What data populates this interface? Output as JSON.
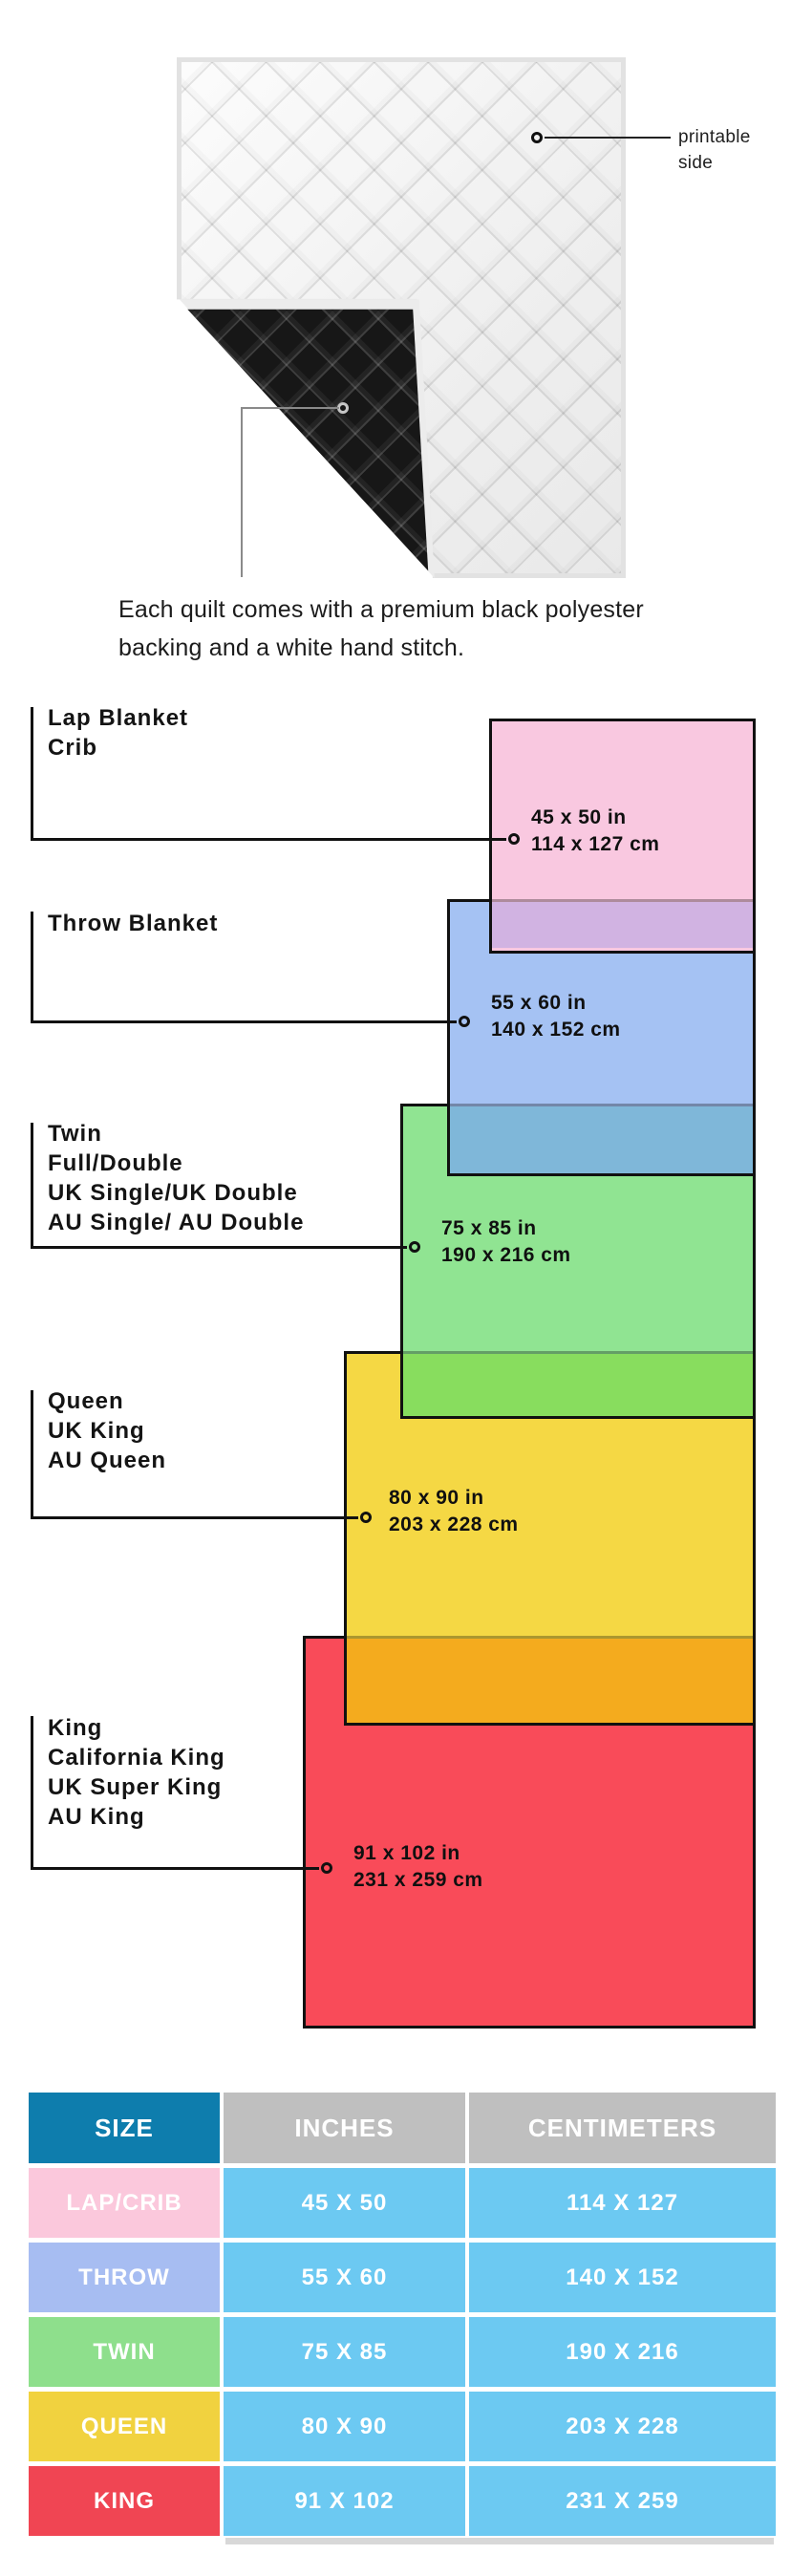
{
  "quilt": {
    "printable_label": "printable side",
    "caption": "Each quilt comes with a premium black polyester backing and a white hand stitch."
  },
  "diagram": {
    "sizes": [
      {
        "name_lines": [
          "Lap Blanket",
          "Crib"
        ],
        "inches": "45 x 50 in",
        "cm": "114 x 127 cm",
        "fill": "#f9c8e0"
      },
      {
        "name_lines": [
          "Throw Blanket"
        ],
        "inches": "55 x 60 in",
        "cm": "140 x 152 cm",
        "fill": "#a5c2f3"
      },
      {
        "name_lines": [
          "Twin",
          "Full/Double",
          "UK Single/UK Double",
          "AU Single/ AU Double"
        ],
        "inches": "75 x 85 in",
        "cm": "190 x 216 cm",
        "fill": "#90e492"
      },
      {
        "name_lines": [
          "Queen",
          "UK King",
          "AU Queen"
        ],
        "inches": "80 x 90 in",
        "cm": "203 x 228 cm",
        "fill": "#f5d844"
      },
      {
        "name_lines": [
          "King",
          "California King",
          "UK Super King",
          "AU King"
        ],
        "inches": "91 x 102 in",
        "cm": "231 x 259 cm",
        "fill": "#f94b59"
      }
    ],
    "overlap_fills": {
      "lap_throw": "#d1b3e2",
      "throw_twin": "#7fb7d9",
      "twin_queen": "#88dd5e",
      "queen_king": "#f4ab1e"
    }
  },
  "table": {
    "headers": [
      "SIZE",
      "INCHES",
      "CENTIMETERS"
    ],
    "header_colors": {
      "size": "#0e7dad",
      "measures": "#bfbfbf"
    },
    "cell_color": "#6cc9f2",
    "rows": [
      {
        "label": "LAP/CRIB",
        "inches": "45 X 50",
        "cm": "114 X 127",
        "color": "#fbc8dc"
      },
      {
        "label": "THROW",
        "inches": "55 X 60",
        "cm": "140 X 152",
        "color": "#a7bdf2"
      },
      {
        "label": "TWIN",
        "inches": "75 X 85",
        "cm": "190 X 216",
        "color": "#8edf8c"
      },
      {
        "label": "QUEEN",
        "inches": "80 X 90",
        "cm": "203 X 228",
        "color": "#f1d23f"
      },
      {
        "label": "KING",
        "inches": "91 X 102",
        "cm": "231 X 259",
        "color": "#f04553"
      }
    ]
  }
}
